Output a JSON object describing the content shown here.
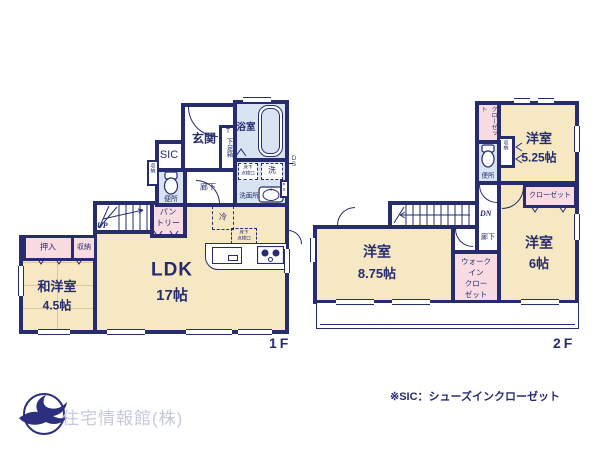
{
  "f1": {
    "floor": "1F",
    "ldk_name": "LDK",
    "ldk_size": "17帖",
    "wayo_name": "和洋室",
    "wayo_size": "4.5帖",
    "genkan": "玄関",
    "sic": "SIC",
    "shoebox_t": "T",
    "shoebox": "下足箱",
    "bath": "浴室",
    "wash": "洗",
    "senmenjo": "洗面所",
    "benjo": "便所",
    "rouka": "廊下",
    "pantry_l1": "パン",
    "pantry_l2": "トリー",
    "oshiire": "押入",
    "shuno_niche": "収納",
    "shuno": "収納",
    "fridge": "冷",
    "insp_l1": "床下",
    "insp_l2": "点検口",
    "up": "UP",
    "ds": "DS",
    "ps": "PS"
  },
  "f2": {
    "floor": "2F",
    "y525_name": "洋室",
    "y525_size": "5.25帖",
    "y875_name": "洋室",
    "y875_size": "8.75帖",
    "y6_name": "洋室",
    "y6_size": "6帖",
    "closet_v": "クローゼット",
    "closet": "クローゼット",
    "wic_l1": "ウォーク",
    "wic_l2": "イン",
    "wic_l3": "クロー",
    "wic_l4": "ゼット",
    "shuno": "収納",
    "benjo": "便所",
    "rouka": "廊下",
    "dn": "DN"
  },
  "footer": {
    "company": "住宅情報館(株)",
    "note": "※SIC：シューズインクローゼット"
  },
  "colors": {
    "wall": "#262c6e",
    "room_cream": "#f6e8c2",
    "wet_blue": "#d8e4f2",
    "storage_pink": "#f8dce1",
    "logo_text": "#c6c8dc"
  }
}
